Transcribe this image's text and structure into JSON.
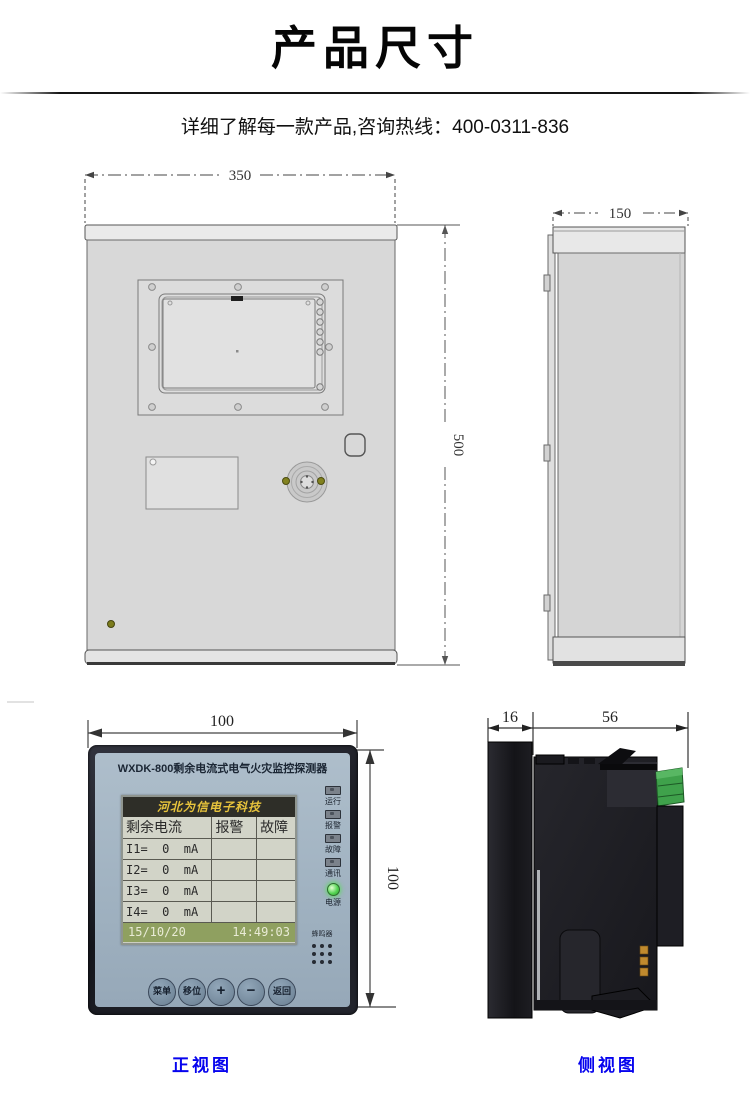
{
  "header": {
    "title": "产品尺寸",
    "subtitle": "详细了解每一款产品,咨询热线：400-0311-836"
  },
  "cabinet_front": {
    "width_dim": "350",
    "height_dim": "500"
  },
  "cabinet_side": {
    "depth_dim": "150"
  },
  "detector_front": {
    "width_dim": "100",
    "height_dim": "100",
    "title": "WXDK-800剩余电流式电气火灾监控探测器",
    "lcd": {
      "brand": "河北为信电子科技",
      "table": {
        "headers": [
          "剩余电流",
          "报警",
          "故障"
        ],
        "rows": [
          [
            "I1=  0  mA",
            "",
            ""
          ],
          [
            "I2=  0  mA",
            "",
            ""
          ],
          [
            "I3=  0  mA",
            "",
            ""
          ],
          [
            "I4=  0  mA",
            "",
            ""
          ]
        ]
      },
      "status": {
        "date": "15/10/20",
        "time": "14:49:03"
      }
    },
    "leds": [
      {
        "label": "运行"
      },
      {
        "label": "报警"
      },
      {
        "label": "故障"
      },
      {
        "label": "通讯"
      },
      {
        "label": "电源",
        "lit": true
      }
    ],
    "buzzer_label": "蜂鸣器",
    "buttons": [
      "菜单",
      "移位",
      "+",
      "−",
      "返回"
    ]
  },
  "detector_side": {
    "front_depth_dim": "16",
    "body_depth_dim": "56"
  },
  "captions": {
    "front_view": "正视图",
    "side_view": "侧视图"
  },
  "colors": {
    "caption_blue": "#0603ee",
    "lcd_brand_gold": "#e7c33c",
    "lcd_status_green": "#8fa060",
    "connector_green": "#3fa14b",
    "device_face_blue": "#9fb1c0"
  }
}
